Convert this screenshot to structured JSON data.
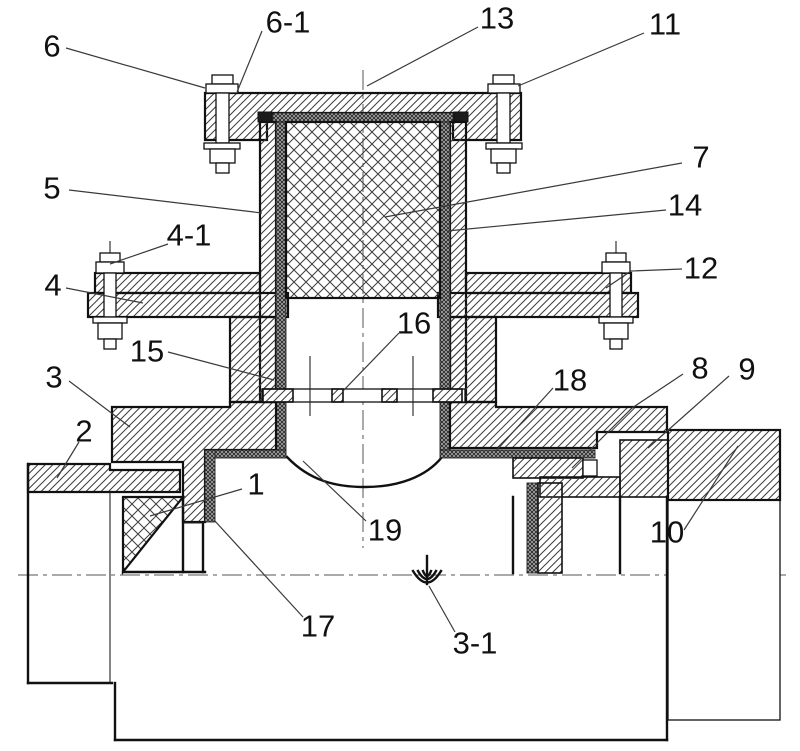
{
  "drawing": {
    "type": "valve-cross-section-patent-figure",
    "background_color": "#ffffff",
    "line_color": "#111111",
    "leader_color": "#3a3a3a",
    "labels": [
      {
        "text": "6",
        "x": 52,
        "y": 46,
        "leader": "66,48 205,88"
      },
      {
        "text": "6-1",
        "x": 288,
        "y": 22,
        "leader": "262,31 237,92"
      },
      {
        "text": "13",
        "x": 497,
        "y": 18,
        "leader": "478,27 367,86"
      },
      {
        "text": "11",
        "x": 665,
        "y": 24,
        "leader": "644,33 518,86"
      },
      {
        "text": "5",
        "x": 52,
        "y": 188,
        "leader": "69,190 262,213"
      },
      {
        "text": "7",
        "x": 701,
        "y": 157,
        "leader": "682,163 385,217"
      },
      {
        "text": "14",
        "x": 685,
        "y": 205,
        "leader": "666,210 447,231"
      },
      {
        "text": "4-1",
        "x": 189,
        "y": 235,
        "leader": "168,244 110,264"
      },
      {
        "text": "4",
        "x": 53,
        "y": 285,
        "leader": "66,288 143,303"
      },
      {
        "text": "12",
        "x": 701,
        "y": 268,
        "leader": "682,269 631,271 606,288"
      },
      {
        "text": "15",
        "x": 147,
        "y": 351,
        "leader": "168,352 274,380"
      },
      {
        "text": "3",
        "x": 54,
        "y": 377,
        "leader": "69,381 130,427"
      },
      {
        "text": "2",
        "x": 84,
        "y": 431,
        "leader": "79,442 57,478"
      },
      {
        "text": "16",
        "x": 414,
        "y": 323,
        "leader": "399,333 343,391"
      },
      {
        "text": "18",
        "x": 570,
        "y": 380,
        "leader": "553,388 495,452"
      },
      {
        "text": "8",
        "x": 700,
        "y": 368,
        "leader": "683,374 632,408 572,468"
      },
      {
        "text": "9",
        "x": 747,
        "y": 369,
        "leader": "729,376 648,448"
      },
      {
        "text": "1",
        "x": 256,
        "y": 484,
        "leader": "242,489 150,516"
      },
      {
        "text": "10",
        "x": 667,
        "y": 532,
        "leader": "684,530 738,446"
      },
      {
        "text": "17",
        "x": 318,
        "y": 626,
        "leader": "303,617 214,520"
      },
      {
        "text": "19",
        "x": 385,
        "y": 530,
        "leader": "366,521 303,461"
      },
      {
        "text": "3-1",
        "x": 475,
        "y": 643,
        "leader": "455,632 429,586"
      }
    ]
  }
}
